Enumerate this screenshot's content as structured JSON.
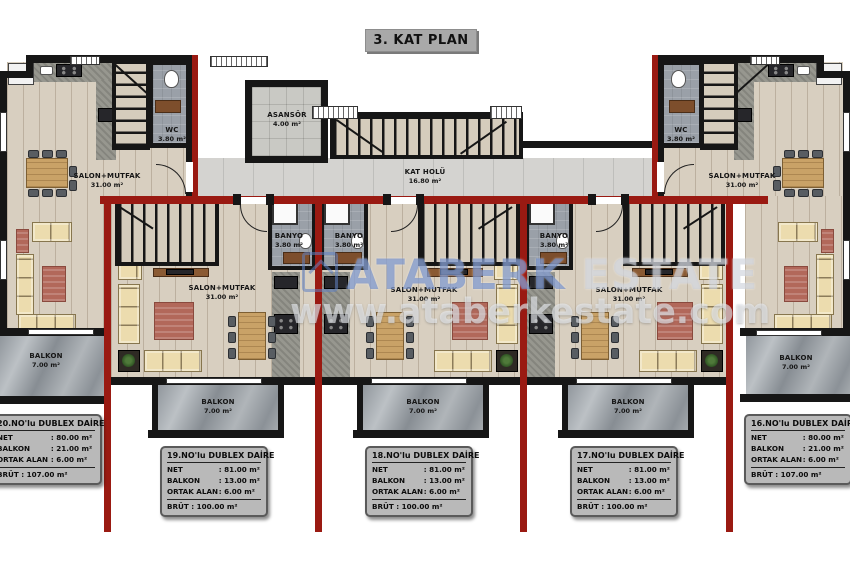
{
  "title": "3. KAT PLAN",
  "watermark": {
    "brand_a": "ATABERK",
    "brand_b": "ESTATE",
    "url": "www.ataberkestate.com"
  },
  "common": {
    "asansor": {
      "name": "ASANSÖR",
      "area": "4.00 m²"
    },
    "kat_holu": {
      "name": "KAT HOLÜ",
      "area": "16.80 m²"
    }
  },
  "units": [
    {
      "no": "20",
      "salon": {
        "name": "SALON+MUTFAK",
        "area": "31.00 m²"
      },
      "wet": {
        "name": "WC",
        "area": "3.80 m²"
      },
      "balkon": {
        "name": "BALKON",
        "area": "7.00 m²"
      },
      "table": {
        "title": "20.NO'lu DUBLEX DAİRE",
        "rows": [
          {
            "label": "NET",
            "value": ": 80.00 m²"
          },
          {
            "label": "BALKON",
            "value": ": 21.00 m²"
          },
          {
            "label": "ORTAK ALAN",
            "value": ": 6.00 m²"
          }
        ],
        "brut": "BRÜT : 107.00 m²"
      }
    },
    {
      "no": "19",
      "salon": {
        "name": "SALON+MUTFAK",
        "area": "31.00 m²"
      },
      "wet": {
        "name": "BANYO",
        "area": "3.80 m²"
      },
      "balkon": {
        "name": "BALKON",
        "area": "7.00 m²"
      },
      "table": {
        "title": "19.NO'lu DUBLEX DAİRE",
        "rows": [
          {
            "label": "NET",
            "value": ": 81.00 m²"
          },
          {
            "label": "BALKON",
            "value": ": 13.00 m²"
          },
          {
            "label": "ORTAK ALAN",
            "value": ": 6.00 m²"
          }
        ],
        "brut": "BRÜT : 100.00 m²"
      }
    },
    {
      "no": "18",
      "salon": {
        "name": "SALON+MUTFAK",
        "area": "31.00 m²"
      },
      "wet": {
        "name": "BANYO",
        "area": "3.80 m²"
      },
      "balkon": {
        "name": "BALKON",
        "area": "7.00 m²"
      },
      "table": {
        "title": "18.NO'lu DUBLEX DAİRE",
        "rows": [
          {
            "label": "NET",
            "value": ": 81.00 m²"
          },
          {
            "label": "BALKON",
            "value": ": 13.00 m²"
          },
          {
            "label": "ORTAK ALAN",
            "value": ": 6.00 m²"
          }
        ],
        "brut": "BRÜT : 100.00 m²"
      }
    },
    {
      "no": "17",
      "salon": {
        "name": "SALON+MUTFAK",
        "area": "31.00 m²"
      },
      "wet": {
        "name": "BANYO",
        "area": "3.80 m²"
      },
      "balkon": {
        "name": "BALKON",
        "area": "7.00 m²"
      },
      "table": {
        "title": "17.NO'lu DUBLEX DAİRE",
        "rows": [
          {
            "label": "NET",
            "value": ": 81.00 m²"
          },
          {
            "label": "BALKON",
            "value": ": 13.00 m²"
          },
          {
            "label": "ORTAK ALAN",
            "value": ": 6.00 m²"
          }
        ],
        "brut": "BRÜT : 100.00 m²"
      }
    },
    {
      "no": "16",
      "salon": {
        "name": "SALON+MUTFAK",
        "area": "31.00 m²"
      },
      "wet": {
        "name": "WC",
        "area": "3.80 m²"
      },
      "balkon": {
        "name": "BALKON",
        "area": "7.00 m²"
      },
      "table": {
        "title": "16.NO'lu DUBLEX DAİRE",
        "rows": [
          {
            "label": "NET",
            "value": ": 80.00 m²"
          },
          {
            "label": "BALKON",
            "value": ": 21.00 m²"
          },
          {
            "label": "ORTAK ALAN",
            "value": ": 6.00 m²"
          }
        ],
        "brut": "BRÜT : 107.00 m²"
      }
    }
  ]
}
